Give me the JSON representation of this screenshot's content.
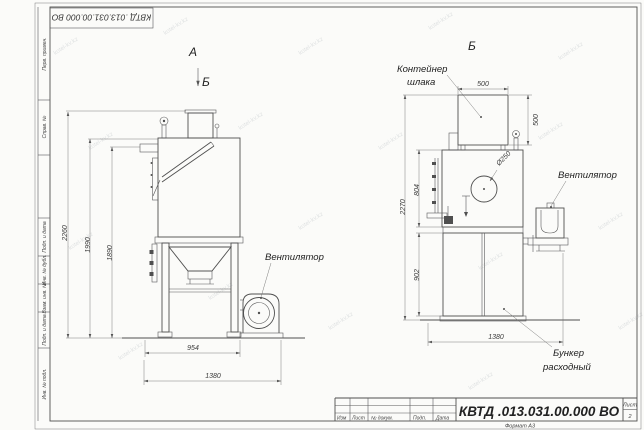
{
  "watermark": {
    "text": "kotel-kv.kz"
  },
  "frame": {
    "top_stamp": "КВТД .013.031.00.000  ВО",
    "format_note": "Формат А3",
    "side_fields": [
      {
        "label": "Перв. примен."
      },
      {
        "label": "Справ. №"
      },
      {
        "label": "Подп. и дата"
      },
      {
        "label": "Инв. № дубл."
      },
      {
        "label": "Взам. инв. №"
      },
      {
        "label": "Подп. и дата"
      },
      {
        "label": "Инв. № подл."
      }
    ]
  },
  "title_block": {
    "doc_number": "КВТД .013.031.00.000  ВО",
    "col_izm": "Изм",
    "col_list": "Лист",
    "col_doc": "№ докум.",
    "col_podp": "Подп.",
    "col_data": "Дата",
    "sheet_label": "Лист",
    "sheet_number": "2"
  },
  "front_view": {
    "view_label": "А",
    "section_mark": "Б",
    "fan_label": "Вентилятор",
    "dim_height_total": "2260",
    "dim_height_body": "1990",
    "dim_height_inlet": "1890",
    "dim_width_body": "954",
    "dim_width_total": "1380"
  },
  "side_view": {
    "view_label": "Б",
    "container_label_line1": "Контейнер",
    "container_label_line2": "шлака",
    "fan_label": "Вентилятор",
    "hopper_label_line1": "Бункер",
    "hopper_label_line2": "расходный",
    "dim_container_width": "500",
    "dim_container_height": "500",
    "dim_height_total": "2270",
    "dim_height_upper": "804",
    "dim_height_lower": "902",
    "dim_width_total": "1380",
    "dim_hole": "Ø250"
  }
}
